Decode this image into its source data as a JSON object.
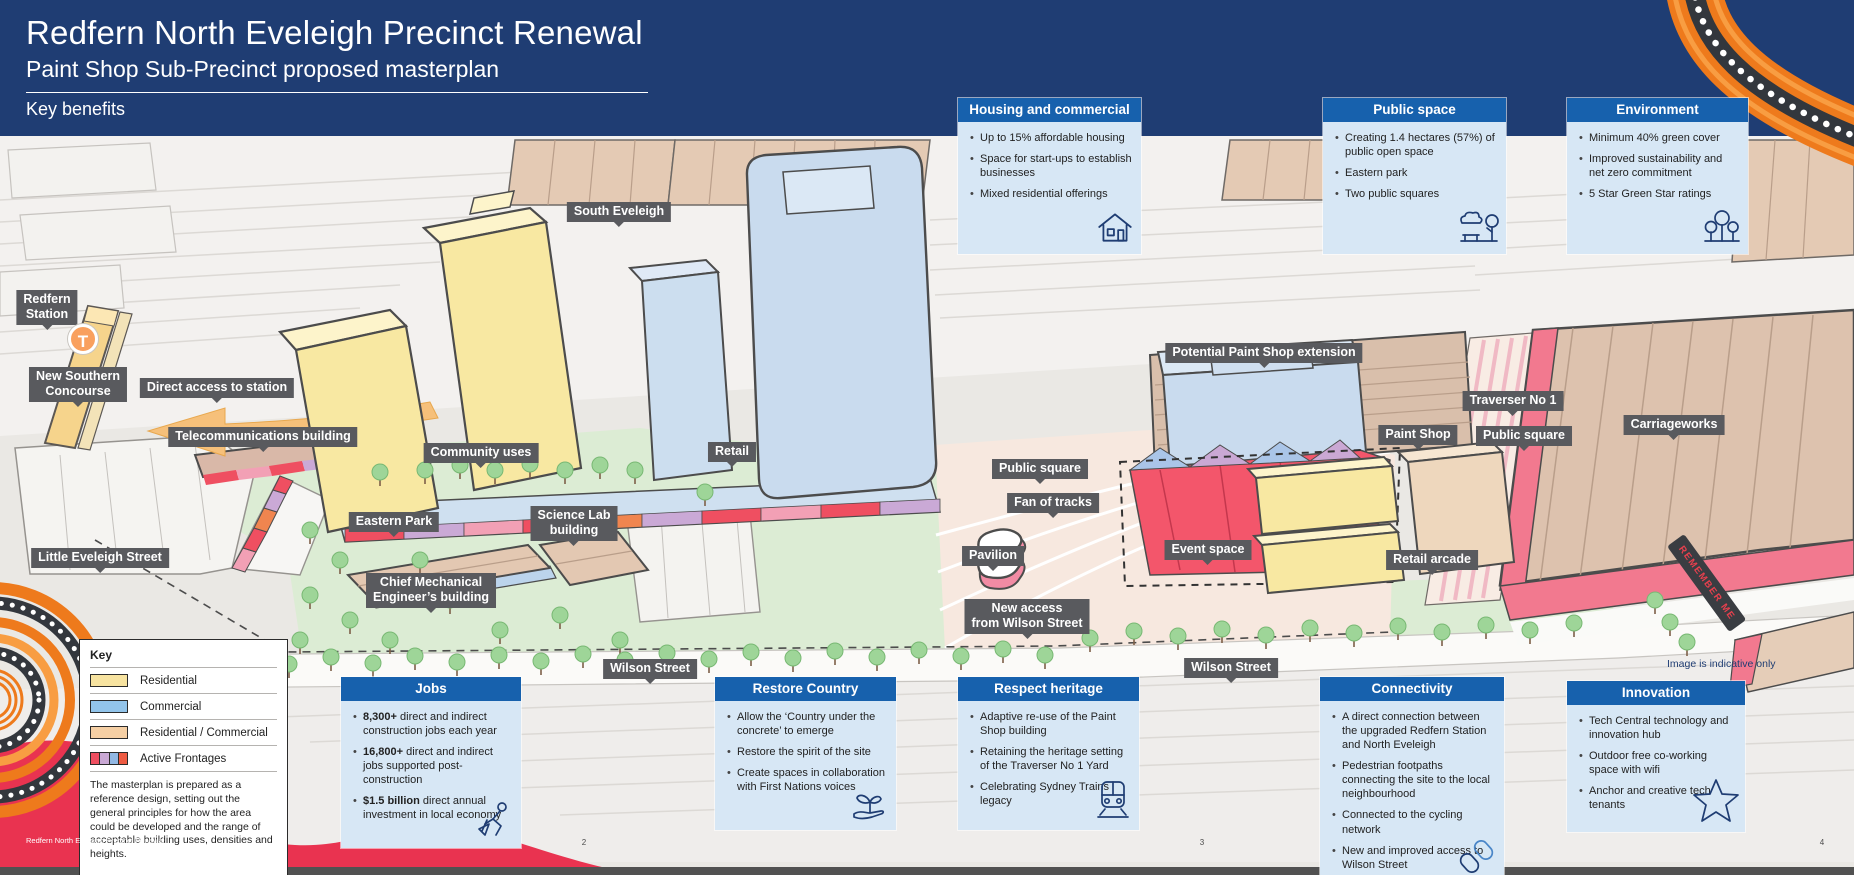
{
  "header": {
    "title": "Redfern North Eveleigh Precinct Renewal",
    "subtitle": "Paint Shop Sub-Precinct proposed masterplan",
    "section": "Key benefits"
  },
  "cards": [
    {
      "title": "Housing and commercial",
      "icon": "house-icon",
      "bullets": [
        {
          "b": "",
          "t": "Up to 15% affordable housing"
        },
        {
          "b": "",
          "t": "Space for start-ups to establish businesses"
        },
        {
          "b": "",
          "t": "Mixed residential offerings"
        }
      ]
    },
    {
      "title": "Public space",
      "icon": "park-icon",
      "bullets": [
        {
          "b": "",
          "t": "Creating 1.4 hectares (57%) of public open space"
        },
        {
          "b": "",
          "t": "Eastern park"
        },
        {
          "b": "",
          "t": "Two public squares"
        }
      ]
    },
    {
      "title": "Environment",
      "icon": "trees-icon",
      "bullets": [
        {
          "b": "",
          "t": "Minimum 40% green cover"
        },
        {
          "b": "",
          "t": "Improved sustainability and net zero commitment"
        },
        {
          "b": "",
          "t": "5 Star Green Star ratings"
        }
      ]
    },
    {
      "title": "Jobs",
      "icon": "construction-worker-icon",
      "bullets": [
        {
          "b": "8,300+",
          "t": " direct and indirect construction jobs each year"
        },
        {
          "b": "16,800+",
          "t": " direct and indirect jobs supported post-construction"
        },
        {
          "b": "$1.5 billion",
          "t": " direct annual investment in local economy"
        }
      ]
    },
    {
      "title": "Restore Country",
      "icon": "seedling-hand-icon",
      "bullets": [
        {
          "b": "",
          "t": "Allow the ‘Country under the concrete’ to emerge"
        },
        {
          "b": "",
          "t": "Restore the spirit of the site"
        },
        {
          "b": "",
          "t": "Create spaces in collaboration with First Nations voices"
        }
      ]
    },
    {
      "title": "Respect heritage",
      "icon": "train-icon",
      "bullets": [
        {
          "b": "",
          "t": "Adaptive re-use of the Paint Shop building"
        },
        {
          "b": "",
          "t": "Retaining the heritage setting of the Traverser No 1 Yard"
        },
        {
          "b": "",
          "t": "Celebrating Sydney Trains legacy"
        }
      ]
    },
    {
      "title": "Connectivity",
      "icon": "chain-links-icon",
      "bullets": [
        {
          "b": "",
          "t": "A direct connection between the upgraded Redfern Station and North Eveleigh"
        },
        {
          "b": "",
          "t": "Pedestrian footpaths connecting the site to the local neighbourhood"
        },
        {
          "b": "",
          "t": "Connected to the cycling network"
        },
        {
          "b": "",
          "t": "New and improved access to Wilson Street"
        }
      ]
    },
    {
      "title": "Innovation",
      "icon": "star-icon",
      "bullets": [
        {
          "b": "",
          "t": "Tech Central technology and innovation hub"
        },
        {
          "b": "",
          "t": "Outdoor free co-working space with wifi"
        },
        {
          "b": "",
          "t": "Anchor and creative tech tenants"
        }
      ]
    }
  ],
  "legend": {
    "title": "Key",
    "items": [
      {
        "label": "Residential",
        "color": "#f7e3a0"
      },
      {
        "label": "Commercial",
        "color": "#92c4ea"
      },
      {
        "label": "Residential / Commercial",
        "color": "#f5cfa4"
      },
      {
        "label": "Active Frontages",
        "colors": [
          "#ef4f61",
          "#c9a8d4",
          "#92b8e4",
          "#ee5b42"
        ]
      }
    ],
    "note": "The masterplan is prepared as a reference design, setting out the general principles for how the area could be developed and the range of acceptable building uses, densities and heights."
  },
  "map": {
    "station_badge": "T",
    "remember_me": "REMEMBER ME",
    "indicative_note": "Image is indicative only",
    "labels": [
      {
        "text": "South Eveleigh"
      },
      {
        "text": "Redfern\nStation"
      },
      {
        "text": "New Southern\nConcourse"
      },
      {
        "text": "Direct access to station"
      },
      {
        "text": "Telecommunications building"
      },
      {
        "text": "Community uses"
      },
      {
        "text": "Retail"
      },
      {
        "text": "Eastern Park"
      },
      {
        "text": "Science Lab\nbuilding"
      },
      {
        "text": "Chief Mechanical\nEngineer’s building"
      },
      {
        "text": "Little Eveleigh Street"
      },
      {
        "text": "Wilson Street"
      },
      {
        "text": "Public square"
      },
      {
        "text": "Fan of tracks"
      },
      {
        "text": "Pavilion"
      },
      {
        "text": "New access\nfrom Wilson Street"
      },
      {
        "text": "Event space"
      },
      {
        "text": "Potential Paint Shop extension"
      },
      {
        "text": "Traverser No 1"
      },
      {
        "text": "Paint Shop"
      },
      {
        "text": "Public square"
      },
      {
        "text": "Carriageworks"
      },
      {
        "text": "Retail arcade"
      },
      {
        "text": "Wilson Street"
      }
    ]
  },
  "footer": {
    "brand": "Redfern North Eveleigh Precinct Renewal",
    "pages": [
      "2",
      "3",
      "4"
    ]
  },
  "colors": {
    "header_navy": "#1f3d73",
    "card_header_blue": "#1761ad",
    "card_body_blue": "#d7e7f5",
    "label_chip_gray": "#595a5e",
    "accent_red": "#e93350",
    "art_orange": "#ee7a1c"
  }
}
